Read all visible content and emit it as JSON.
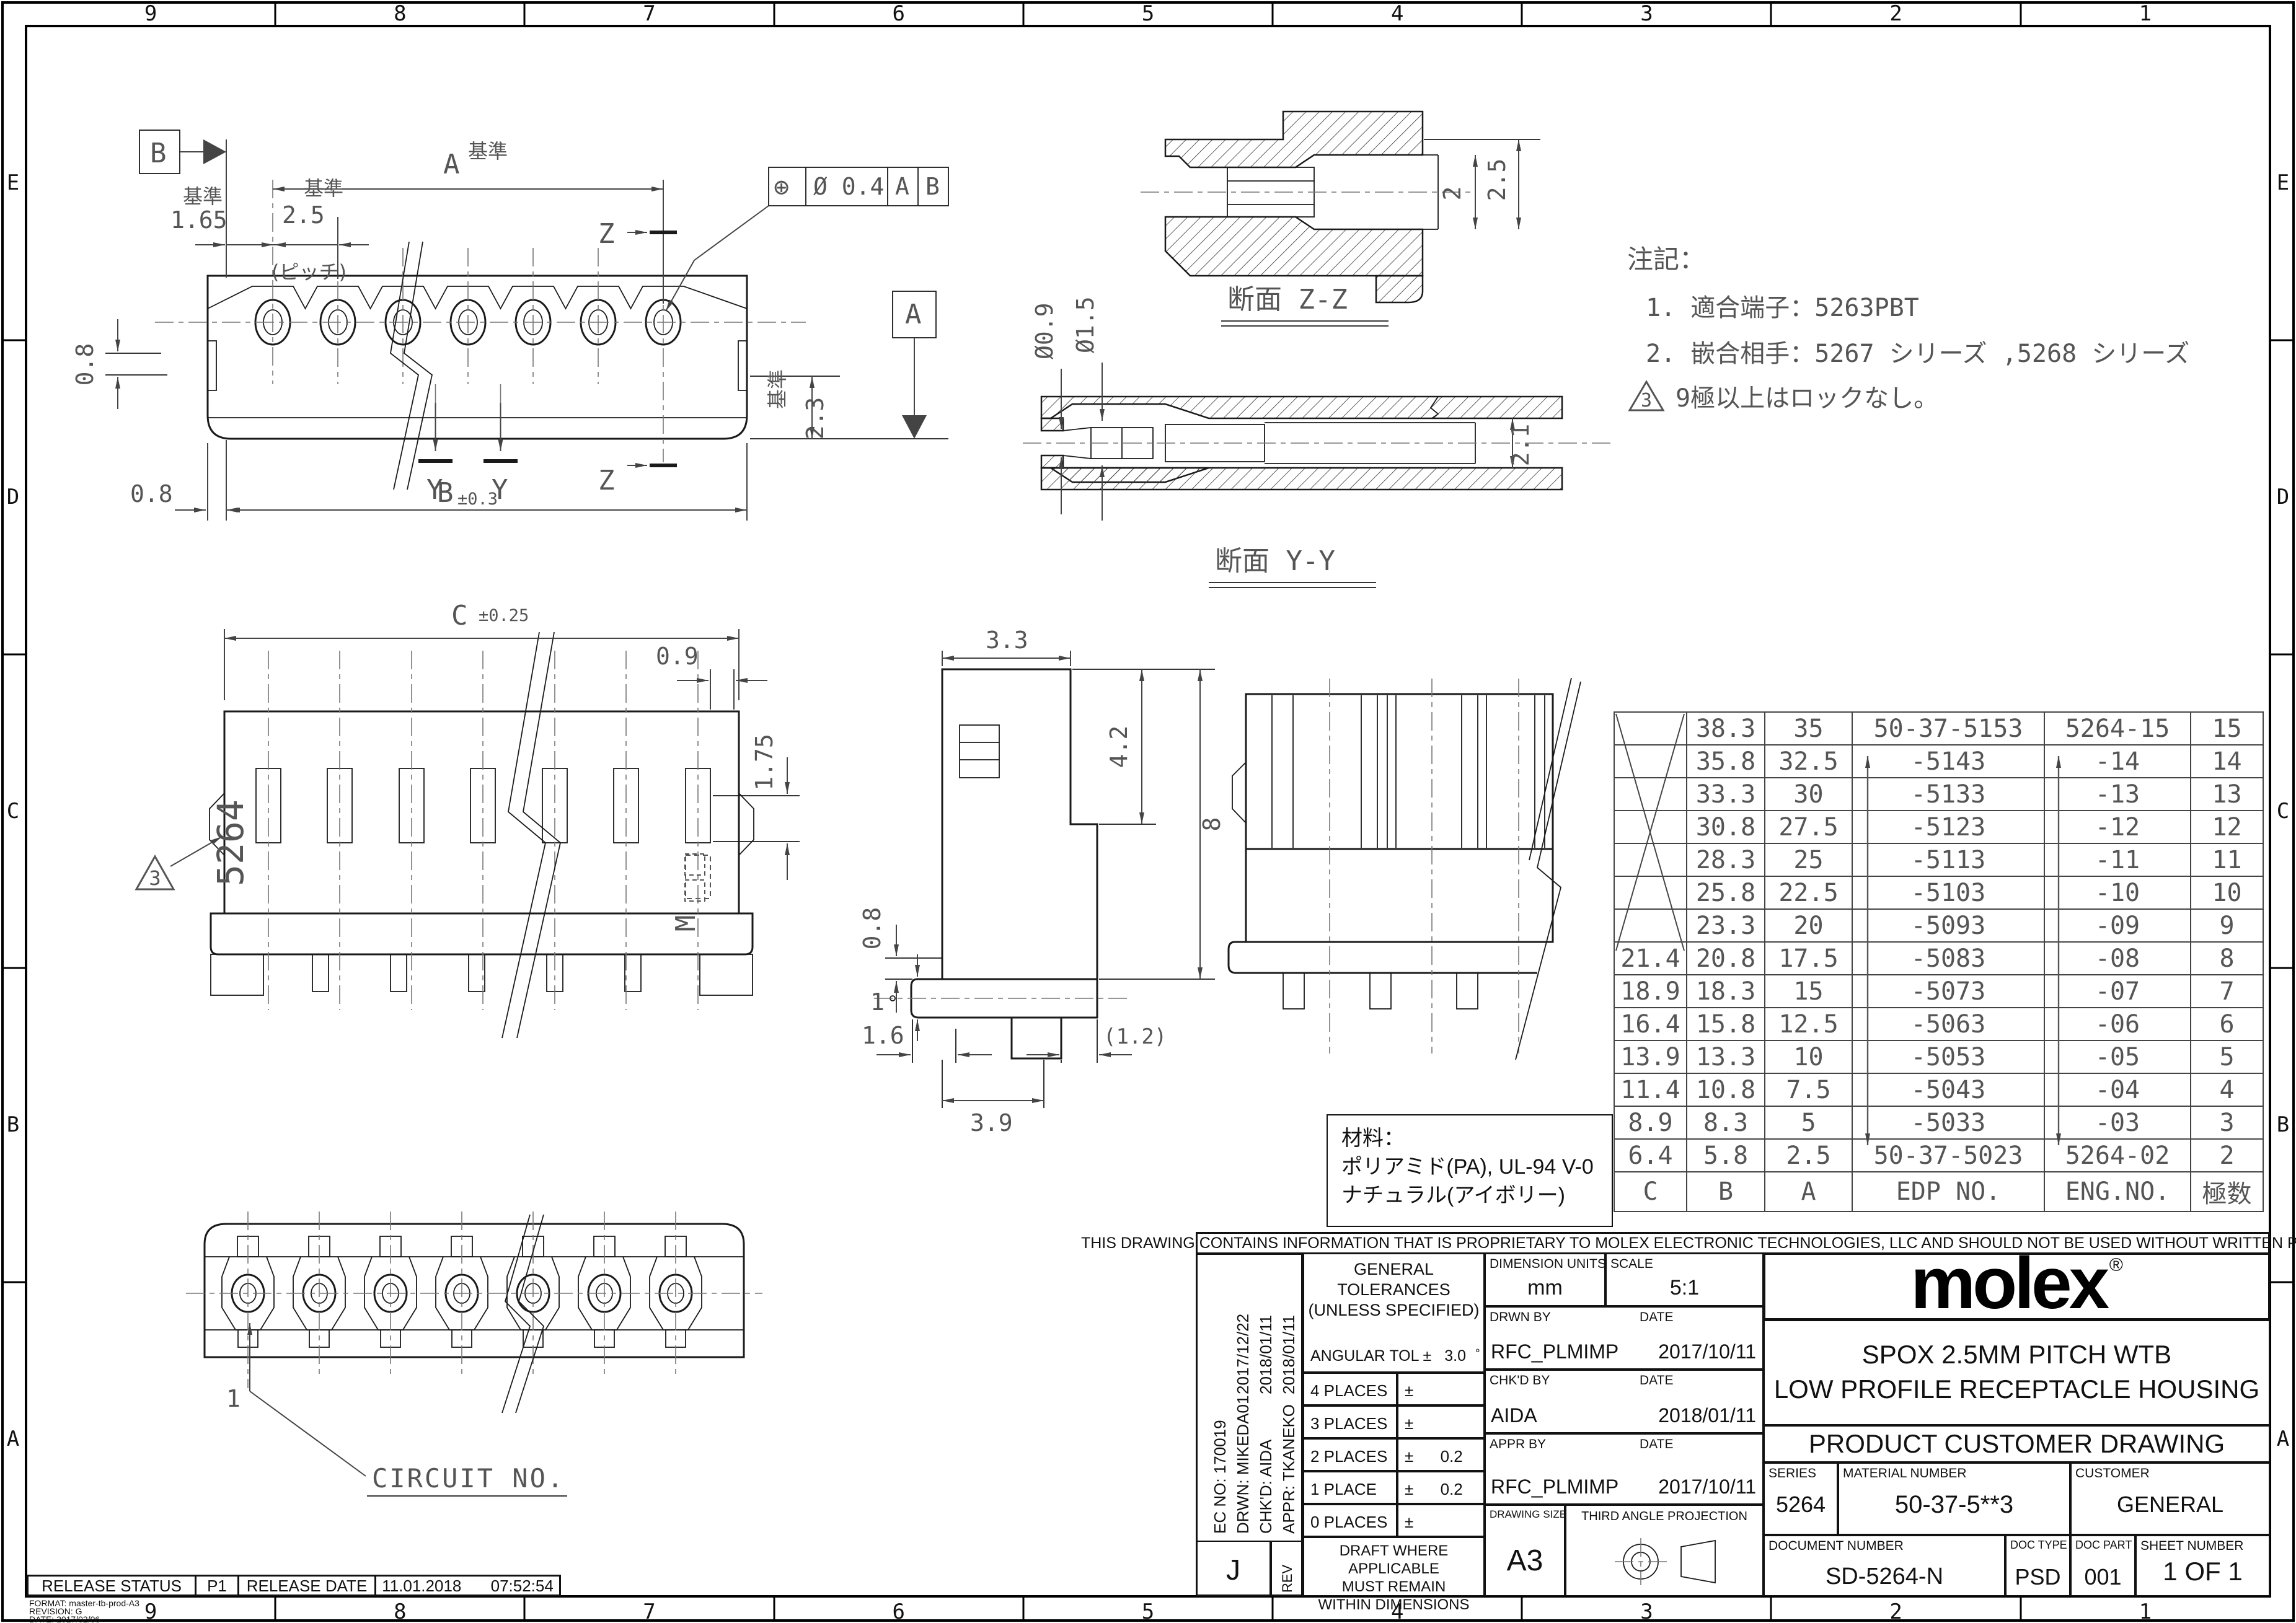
{
  "border": {
    "columns": [
      "9",
      "8",
      "7",
      "6",
      "5",
      "4",
      "3",
      "2",
      "1"
    ],
    "rows": [
      "E",
      "D",
      "C",
      "B",
      "A"
    ]
  },
  "views": {
    "top_view": {
      "dim_overall": "A",
      "kijun": "基準",
      "dim_left": "1.65",
      "dim_pitch": "2.5",
      "pitch_note": "(ピッチ)",
      "section_z": "Z",
      "section_y": "Y",
      "dim_step_upper": "0.8",
      "dim_step_lower": "0.8",
      "dim_b": "B",
      "dim_b_tol": "±0.3",
      "dim_right": "2.3",
      "fcf": {
        "symbol": "⊕",
        "tolerance": "Ø 0.4",
        "datum1": "A",
        "datum2": "B"
      },
      "datum_a": "A",
      "datum_b": "B"
    },
    "section_zz": {
      "title": "断面 Z-Z",
      "dim_inner": "2",
      "dim_outer": "2.5"
    },
    "section_yy": {
      "title": "断面 Y-Y",
      "dim_hole": "Ø0.9",
      "dim_bore": "Ø1.5",
      "dim_height": "2.1"
    },
    "front_view": {
      "dim_c": "C",
      "dim_c_tol": "±0.25",
      "dim_slot": "0.9",
      "dim_slot_h": "1.75",
      "molded_text": "5264",
      "marking": "M",
      "flag": "3"
    },
    "side_view": {
      "dim_w": "3.3",
      "dim_h1": "4.2",
      "dim_h2": "8",
      "dim_s1": "0.8",
      "dim_s2": "1",
      "dim_b1": "1.6",
      "dim_b2": "(1.2)",
      "dim_b3": "3.9"
    },
    "bottom_view": {
      "pin1": "1",
      "circuit_label": "CIRCUIT NO."
    }
  },
  "notes": {
    "title": "注記：",
    "items": [
      "1. 適合端子：5263PBT",
      "2. 嵌合相手：5267 シリーズ ,5268 シリーズ"
    ],
    "flag_num": "3",
    "flag_text": "9極以上はロックなし。"
  },
  "material": {
    "title": "材料：",
    "line1": "ポリアミド(PA), UL-94 V-0",
    "line2": "ナチュラル(アイボリー)"
  },
  "parts_table": {
    "headers": [
      "C",
      "B",
      "A",
      "EDP NO.",
      "ENG.NO.",
      "極数"
    ],
    "rows": [
      {
        "c": "",
        "b": "38.3",
        "a": "35",
        "edp": "50-37-5153",
        "eng": "5264-15",
        "poles": "15"
      },
      {
        "c": "",
        "b": "35.8",
        "a": "32.5",
        "edp": "-5143",
        "eng": "-14",
        "poles": "14"
      },
      {
        "c": "",
        "b": "33.3",
        "a": "30",
        "edp": "-5133",
        "eng": "-13",
        "poles": "13"
      },
      {
        "c": "",
        "b": "30.8",
        "a": "27.5",
        "edp": "-5123",
        "eng": "-12",
        "poles": "12"
      },
      {
        "c": "",
        "b": "28.3",
        "a": "25",
        "edp": "-5113",
        "eng": "-11",
        "poles": "11"
      },
      {
        "c": "",
        "b": "25.8",
        "a": "22.5",
        "edp": "-5103",
        "eng": "-10",
        "poles": "10"
      },
      {
        "c": "",
        "b": "23.3",
        "a": "20",
        "edp": "-5093",
        "eng": "-09",
        "poles": "9"
      },
      {
        "c": "21.4",
        "b": "20.8",
        "a": "17.5",
        "edp": "-5083",
        "eng": "-08",
        "poles": "8"
      },
      {
        "c": "18.9",
        "b": "18.3",
        "a": "15",
        "edp": "-5073",
        "eng": "-07",
        "poles": "7"
      },
      {
        "c": "16.4",
        "b": "15.8",
        "a": "12.5",
        "edp": "-5063",
        "eng": "-06",
        "poles": "6"
      },
      {
        "c": "13.9",
        "b": "13.3",
        "a": "10",
        "edp": "-5053",
        "eng": "-05",
        "poles": "5"
      },
      {
        "c": "11.4",
        "b": "10.8",
        "a": "7.5",
        "edp": "-5043",
        "eng": "-04",
        "poles": "4"
      },
      {
        "c": "8.9",
        "b": "8.3",
        "a": "5",
        "edp": "-5033",
        "eng": "-03",
        "poles": "3"
      },
      {
        "c": "6.4",
        "b": "5.8",
        "a": "2.5",
        "edp": "50-37-5023",
        "eng": "5264-02",
        "poles": "2"
      }
    ]
  },
  "title_block": {
    "proprietary": "THIS DRAWING CONTAINS INFORMATION THAT IS PROPRIETARY TO MOLEX ELECTRONIC TECHNOLOGIES, LLC AND SHOULD NOT BE USED WITHOUT WRITTEN PERMISSION",
    "ec": {
      "ec_no": "EC NO:  170019",
      "drwn": "DRWN:  MIKEDA01",
      "chkd": "CHK'D:  AIDA",
      "appr": "APPR:  TKANEKO",
      "date1": "2017/12/22",
      "date2": "2018/01/11",
      "date3": "2018/01/11"
    },
    "rev": {
      "value": "J",
      "label": "REV"
    },
    "tolerances": {
      "title1": "GENERAL",
      "title2": "TOLERANCES",
      "title3": "(UNLESS SPECIFIED)",
      "angular_label": "ANGULAR TOL ±",
      "angular_value": "3.0",
      "angular_unit": "°",
      "rows": [
        {
          "label": "4 PLACES",
          "pm": "±",
          "value": ""
        },
        {
          "label": "3 PLACES",
          "pm": "±",
          "value": ""
        },
        {
          "label": "2 PLACES",
          "pm": "±",
          "value": "0.2"
        },
        {
          "label": "1 PLACE",
          "pm": "±",
          "value": "0.2"
        },
        {
          "label": "0 PLACES",
          "pm": "±",
          "value": ""
        }
      ],
      "draft1": "DRAFT WHERE APPLICABLE",
      "draft2": "MUST REMAIN",
      "draft3": "WITHIN DIMENSIONS"
    },
    "info": {
      "units_label": "DIMENSION UNITS",
      "units": "mm",
      "scale_label": "SCALE",
      "scale": "5:1",
      "drwn_by_label": "DRWN BY",
      "date_label": "DATE",
      "drwn_by": "RFC_PLMIMP",
      "drwn_date": "2017/10/11",
      "chkd_by_label": "CHK'D BY",
      "chkd_by": "AIDA",
      "chkd_date": "2018/01/11",
      "appr_by_label": "APPR BY",
      "appr_by": "RFC_PLMIMP",
      "appr_date": "2017/10/11",
      "size_label": "DRAWING SIZE",
      "size": "A3",
      "projection_label": "THIRD ANGLE PROJECTION"
    },
    "brand": {
      "logo": "molex",
      "reg": "®"
    },
    "title_line1": "SPOX 2.5MM PITCH WTB",
    "title_line2": "LOW PROFILE RECEPTACLE HOUSING",
    "doc_band": "PRODUCT CUSTOMER DRAWING",
    "series_label": "SERIES",
    "series": "5264",
    "material_label": "MATERIAL NUMBER",
    "material": "50-37-5**3",
    "customer_label": "CUSTOMER",
    "customer": "GENERAL",
    "docnum_label": "DOCUMENT NUMBER",
    "docnum": "SD-5264-N",
    "doctype_label": "DOC TYPE",
    "doctype": "PSD",
    "docpart_label": "DOC PART",
    "docpart": "001",
    "sheet_label": "SHEET NUMBER",
    "sheet": "1 OF 1"
  },
  "release": {
    "status_label": "RELEASE STATUS",
    "status": "P1",
    "date_label": "RELEASE DATE",
    "date": "11.01.2018",
    "time": "07:52:54"
  },
  "format_note": {
    "format": "FORMAT: master-tb-prod-A3",
    "revision": "REVISION: G",
    "date": "DATE: 2017/02/06"
  }
}
